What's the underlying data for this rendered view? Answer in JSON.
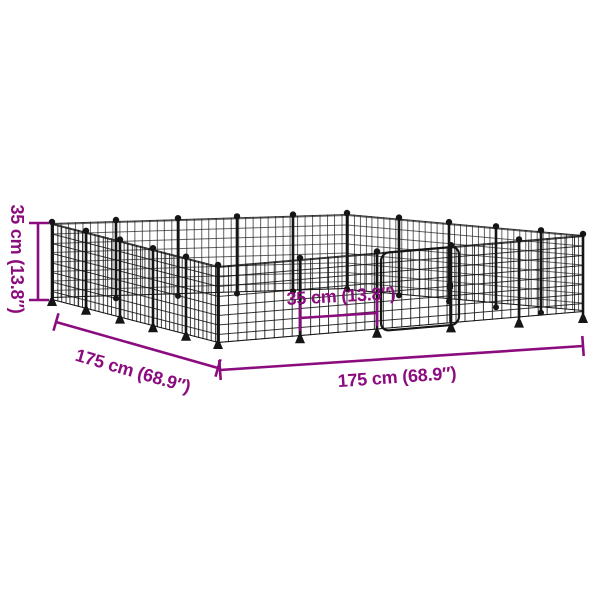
{
  "diagram": {
    "labels": {
      "height": "35 cm (13.8″)",
      "depth": "175 cm (68.9″)",
      "width": "175 cm (68.9″)",
      "panel": "35 cm (13.8″)"
    },
    "colors": {
      "dimension": "#8B0C7E",
      "mesh": "#151515",
      "background": "#FFFFFF"
    }
  }
}
